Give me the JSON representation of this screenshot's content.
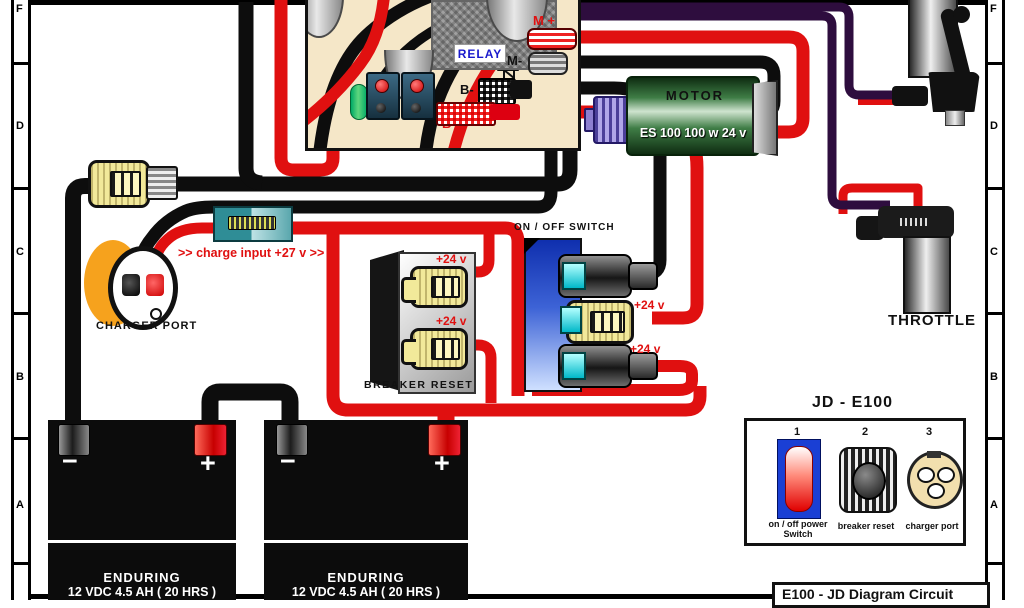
{
  "frame": {
    "ruler_letters": [
      "F",
      "D",
      "C",
      "B",
      "A"
    ]
  },
  "controller": {
    "relay_label": "RELAY",
    "terminals": {
      "m_plus": "M +",
      "m_minus": "M-",
      "b_minus": "B-",
      "b_plus": "B +"
    }
  },
  "motor": {
    "name": "MOTOR",
    "spec": "ES 100 100 w 24 v"
  },
  "charger": {
    "port_label": "CHARGER PORT",
    "input_label": ">> charge input +27 v >>"
  },
  "breaker": {
    "label": "BREAKER RESET",
    "voltages": [
      "+24 v",
      "+24 v"
    ]
  },
  "switch": {
    "label": "ON / OFF SWITCH",
    "voltages": [
      "+24 v",
      "+24 v"
    ]
  },
  "throttle": {
    "label": "THROTTLE"
  },
  "batteries": [
    {
      "brand": "ENDURING",
      "spec": "12 VDC 4.5 AH ( 20 HRS )",
      "neg": "−",
      "pos": "+"
    },
    {
      "brand": "ENDURING",
      "spec": "12 VDC 4.5 AH ( 20 HRS )",
      "neg": "−",
      "pos": "+"
    }
  ],
  "legend": {
    "title": "JD - E100",
    "items": [
      {
        "num": "1",
        "label_line1": "on / off power",
        "label_line2": "Switch"
      },
      {
        "num": "2",
        "label_line1": "breaker reset",
        "label_line2": ""
      },
      {
        "num": "3",
        "label_line1": "charger port",
        "label_line2": ""
      }
    ]
  },
  "footer": {
    "title": "E100 - JD Diagram Circuit"
  },
  "colors": {
    "wire_red": "#e01010",
    "wire_black": "#0d0d0d",
    "wire_purple": "#2e0d3e",
    "board_tan": "#f5e7c8",
    "motor_green": "#2f6e35",
    "switch_blue": "#2244cc",
    "connector_yellow": "#f2e99a",
    "fuse_teal": "#2f8d96",
    "charger_orange": "#f6a21d"
  }
}
